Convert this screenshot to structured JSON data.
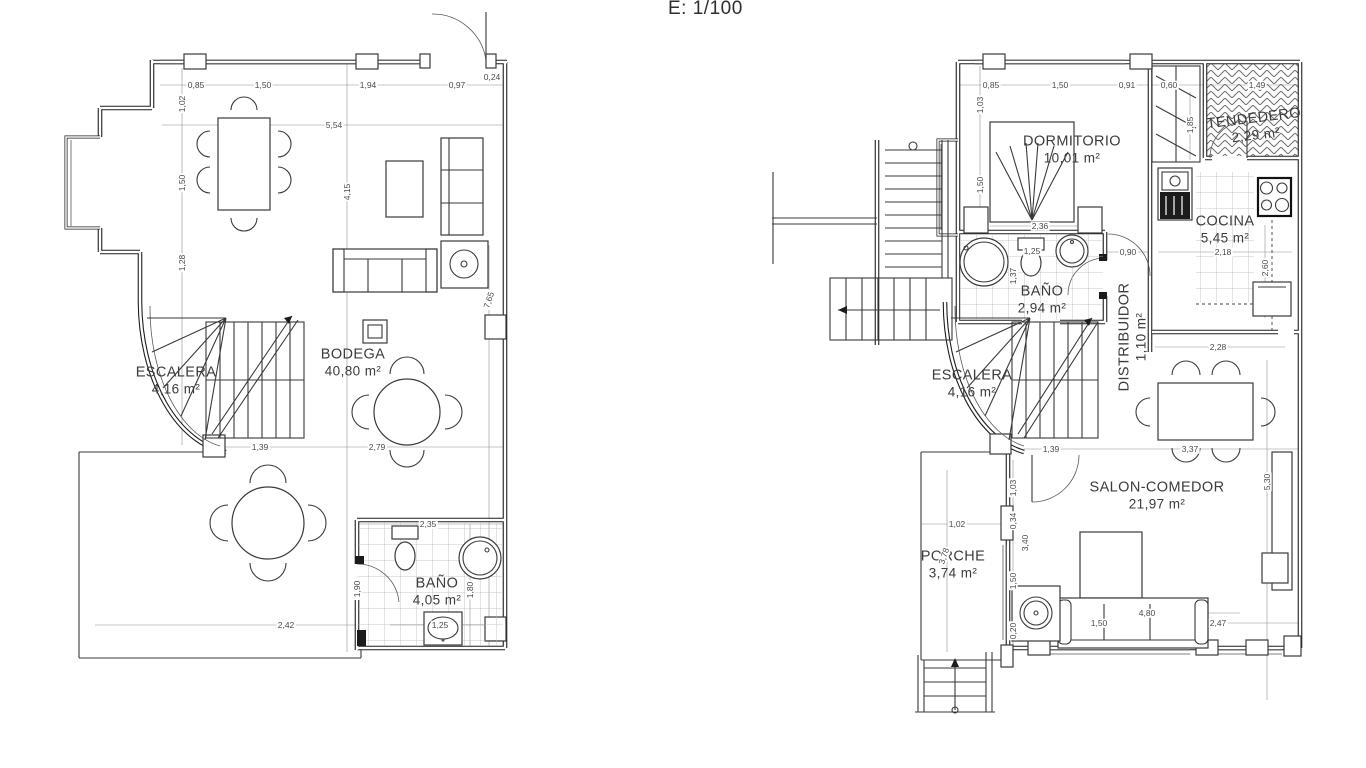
{
  "title": "E: 1/100",
  "colors": {
    "background": "#ffffff",
    "line": "#1e1e1e",
    "dim_text": "#4a4a4a",
    "label_text": "#3c3c3c"
  },
  "plans": [
    {
      "id": "lower-floor-plan",
      "rooms": [
        {
          "name": "BODEGA",
          "area": "40,80 m²",
          "x": 353,
          "y": 363
        },
        {
          "name": "ESCALERA",
          "area": "4,16 m²",
          "x": 176,
          "y": 381
        },
        {
          "name": "BAÑO",
          "area": "4,05 m²",
          "x": 437,
          "y": 592
        }
      ],
      "dimensions": [
        {
          "t": "0,85",
          "x": 196,
          "y": 85
        },
        {
          "t": "1,50",
          "x": 263,
          "y": 85
        },
        {
          "t": "1,94",
          "x": 368,
          "y": 85
        },
        {
          "t": "0,97",
          "x": 457,
          "y": 85
        },
        {
          "t": "0,24",
          "x": 492,
          "y": 77
        },
        {
          "t": "5,54",
          "x": 334,
          "y": 125
        },
        {
          "t": "1,02",
          "x": 182,
          "y": 104,
          "r": -90
        },
        {
          "t": "1,50",
          "x": 182,
          "y": 183,
          "r": -90
        },
        {
          "t": "1,28",
          "x": 182,
          "y": 263,
          "r": -90
        },
        {
          "t": "4,15",
          "x": 347,
          "y": 192,
          "r": -90
        },
        {
          "t": "7,65",
          "x": 489,
          "y": 300,
          "r": -72
        },
        {
          "t": "1,39",
          "x": 260,
          "y": 447
        },
        {
          "t": "2,79",
          "x": 377,
          "y": 447
        },
        {
          "t": "2,35",
          "x": 428,
          "y": 524
        },
        {
          "t": "1,90",
          "x": 357,
          "y": 589,
          "r": -90
        },
        {
          "t": "1,80",
          "x": 470,
          "y": 590,
          "r": -90
        },
        {
          "t": "1,25",
          "x": 440,
          "y": 625
        },
        {
          "t": "2,42",
          "x": 286,
          "y": 625
        }
      ]
    },
    {
      "id": "main-floor-plan",
      "rooms": [
        {
          "name": "DORMITORIO",
          "area": "10,01 m²",
          "x": 1072,
          "y": 150
        },
        {
          "name": "TENDEDERO",
          "area": "2,29 m²",
          "x": 1255,
          "y": 127,
          "r": -7
        },
        {
          "name": "COCINA",
          "area": "5,45 m²",
          "x": 1225,
          "y": 230
        },
        {
          "name": "BAÑO",
          "area": "2,94 m²",
          "x": 1042,
          "y": 300
        },
        {
          "name": "DISTRIBUIDOR",
          "area": "1,10 m²",
          "x": 1133,
          "y": 337,
          "r": -90
        },
        {
          "name": "ESCALERA",
          "area": "4,16 m²",
          "x": 972,
          "y": 384
        },
        {
          "name": "SALON-COMEDOR",
          "area": "21,97 m²",
          "x": 1157,
          "y": 496
        },
        {
          "name": "PORCHE",
          "area": "3,74 m²",
          "x": 953,
          "y": 565
        }
      ],
      "dimensions": [
        {
          "t": "0,85",
          "x": 991,
          "y": 85
        },
        {
          "t": "1,50",
          "x": 1060,
          "y": 85
        },
        {
          "t": "0,91",
          "x": 1127,
          "y": 85
        },
        {
          "t": "0,60",
          "x": 1169,
          "y": 85
        },
        {
          "t": "1,49",
          "x": 1257,
          "y": 85
        },
        {
          "t": "1,03",
          "x": 980,
          "y": 105,
          "r": -90
        },
        {
          "t": "1,50",
          "x": 980,
          "y": 185,
          "r": -90
        },
        {
          "t": "2,36",
          "x": 1040,
          "y": 226
        },
        {
          "t": "1,85",
          "x": 1190,
          "y": 125,
          "r": -90
        },
        {
          "t": "1,37",
          "x": 1013,
          "y": 276,
          "r": -90
        },
        {
          "t": "1,25",
          "x": 1032,
          "y": 251
        },
        {
          "t": "0,90",
          "x": 1128,
          "y": 252
        },
        {
          "t": "2,18",
          "x": 1223,
          "y": 252
        },
        {
          "t": "2,60",
          "x": 1265,
          "y": 268,
          "r": -90
        },
        {
          "t": "2,28",
          "x": 1218,
          "y": 347
        },
        {
          "t": "1,39",
          "x": 1051,
          "y": 449
        },
        {
          "t": "3,37",
          "x": 1190,
          "y": 449
        },
        {
          "t": "5,30",
          "x": 1267,
          "y": 482,
          "r": -90
        },
        {
          "t": "1,02",
          "x": 957,
          "y": 524
        },
        {
          "t": "3,78",
          "x": 944,
          "y": 556,
          "r": -72
        },
        {
          "t": "1,03",
          "x": 1013,
          "y": 488,
          "r": -90
        },
        {
          "t": "0,34",
          "x": 1013,
          "y": 521,
          "r": -90
        },
        {
          "t": "3,40",
          "x": 1025,
          "y": 543,
          "r": -90
        },
        {
          "t": "1,50",
          "x": 1013,
          "y": 581,
          "r": -90
        },
        {
          "t": "0,20",
          "x": 1013,
          "y": 631,
          "r": -90
        },
        {
          "t": "4,80",
          "x": 1147,
          "y": 613
        },
        {
          "t": "1,50",
          "x": 1099,
          "y": 623
        },
        {
          "t": "2,47",
          "x": 1218,
          "y": 623
        }
      ]
    }
  ]
}
